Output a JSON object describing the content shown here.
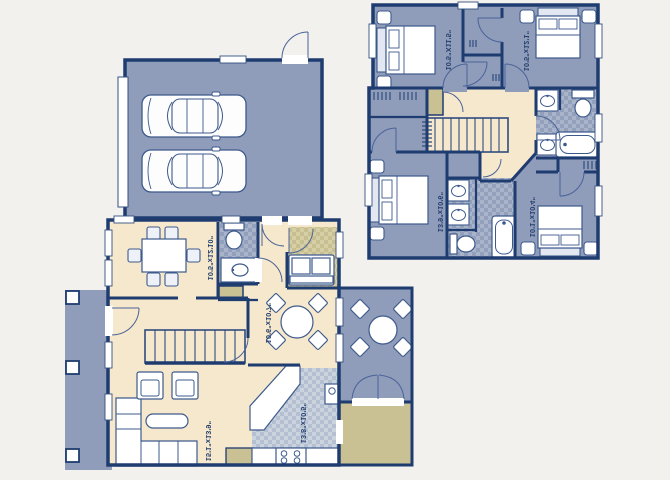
{
  "title": "Two-story floor plan",
  "colors": {
    "room_blue": "#8F9CBA",
    "floor_cream": "#F6E8CC",
    "accent_khaki": "#C9C193",
    "wall_navy": "#1F3C70",
    "background": "#F2F1ED"
  },
  "first_floor": {
    "dining_room": {
      "dimensions": "10'5\"x12'10\""
    },
    "breakfast_nook": {
      "dimensions": "10'6\"x10'7\""
    },
    "living_room": {
      "dimensions": "15'1\"x13'9\""
    },
    "kitchen": {
      "dimensions": "13'8\"x10'5\""
    }
  },
  "second_floor": {
    "bedroom_top_left": {
      "dimensions": "10'5\"X11'5\""
    },
    "bedroom_top_right": {
      "dimensions": "10'5\"x12'1\""
    },
    "master_bedroom": {
      "dimensions": "13'9\"x10'6\""
    },
    "bedroom_bottom_right": {
      "dimensions": "10'1\"x10'4\""
    }
  }
}
